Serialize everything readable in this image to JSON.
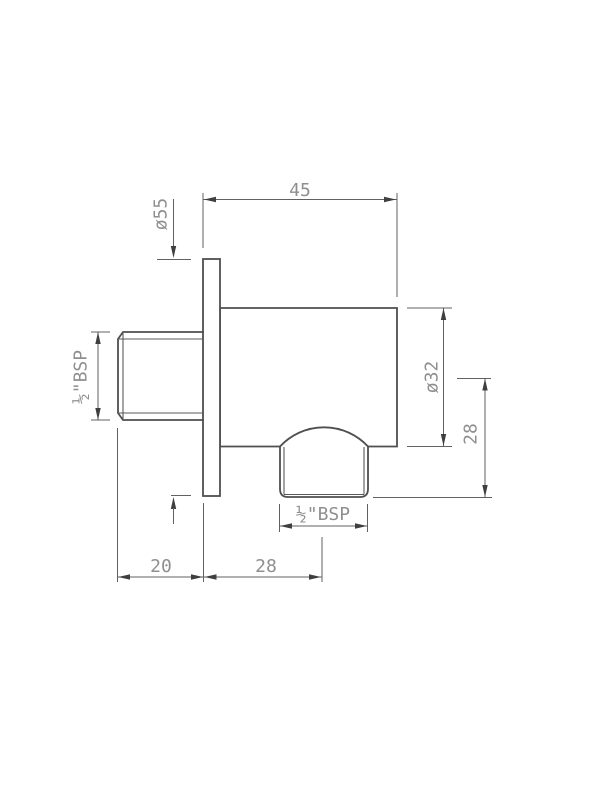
{
  "drawing": {
    "colors": {
      "background": "#ffffff",
      "part_outline": "#4f4f4f",
      "dimension_lines": "#616161",
      "dimension_text": "#8f8f8f"
    },
    "labels": {
      "overall_depth": "45",
      "flange_diameter": "ø55",
      "inlet_thread": "½\"BSP",
      "body_diameter": "ø32",
      "outlet_drop": "28",
      "outlet_thread": "½\"BSP",
      "inlet_length": "20",
      "outlet_center_offset": "28"
    }
  }
}
